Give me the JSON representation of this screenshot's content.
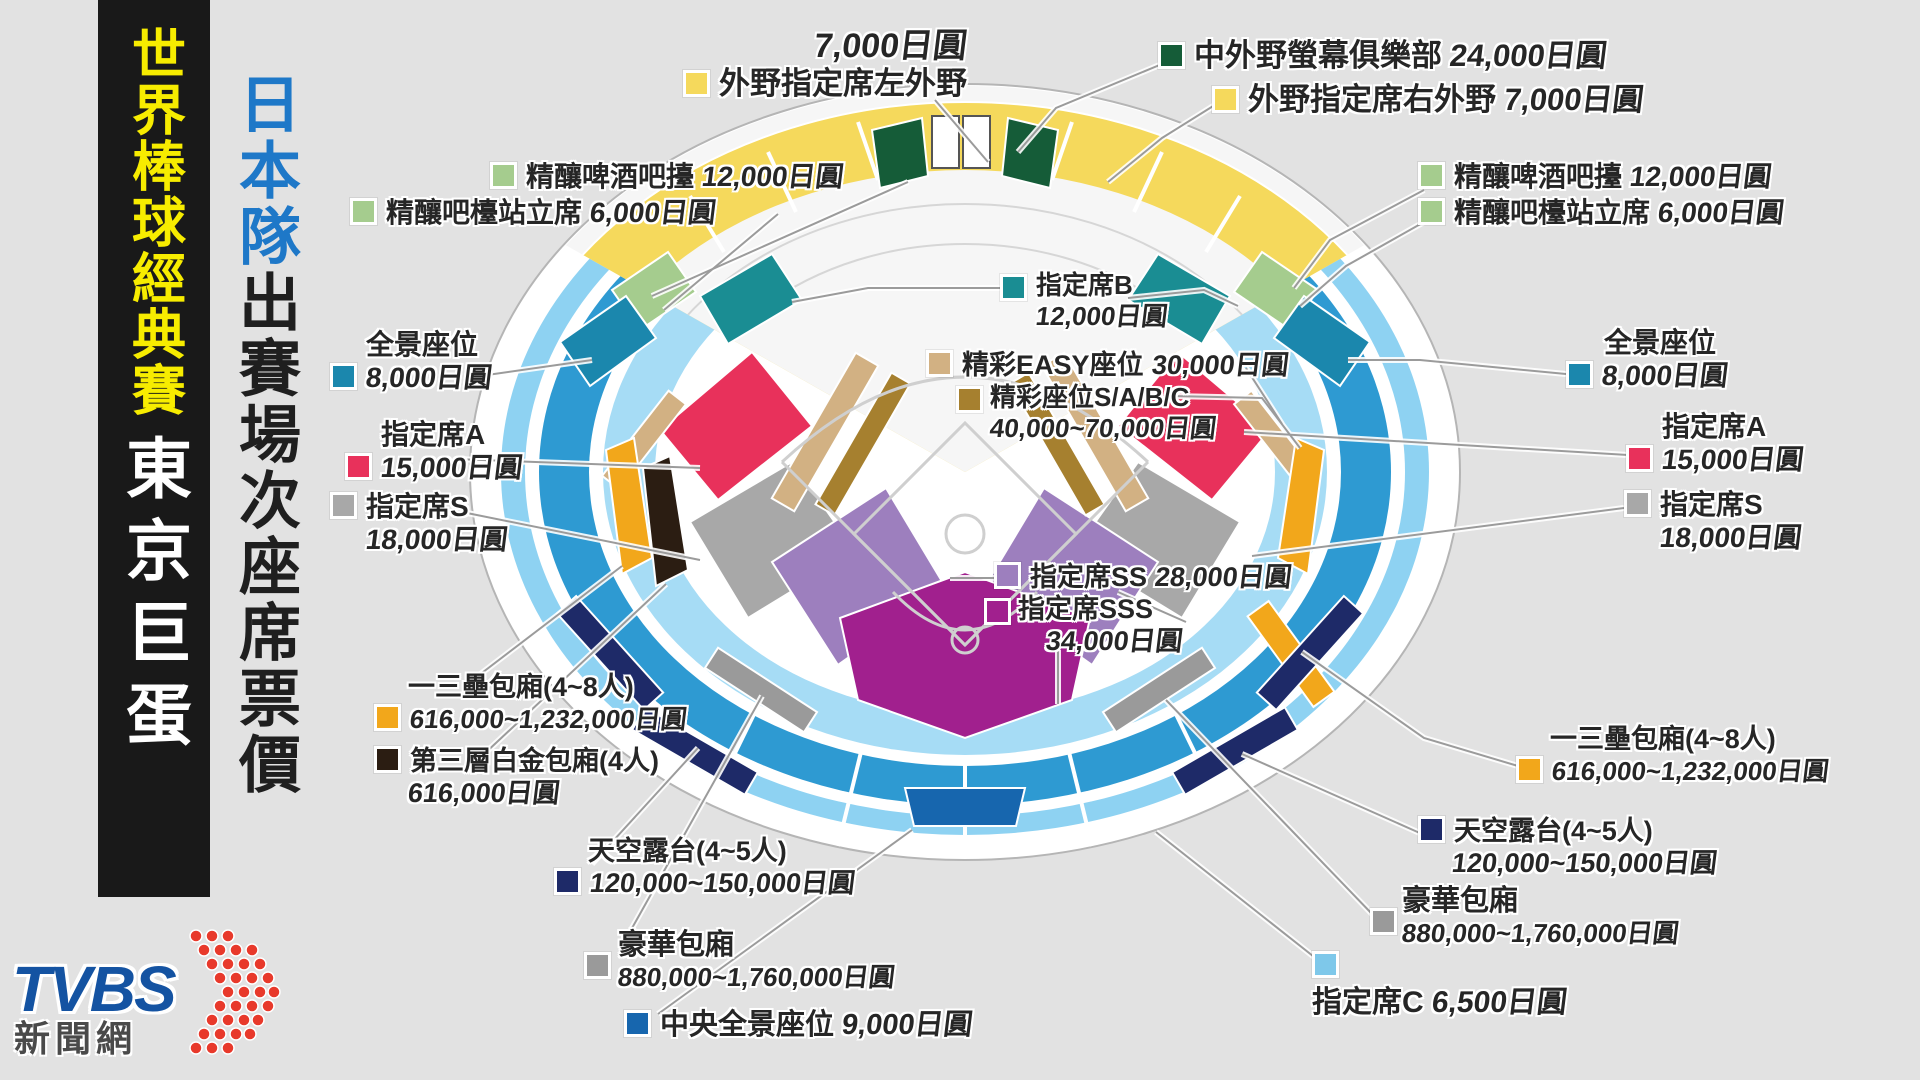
{
  "titles": {
    "main": "世界棒球經典賽",
    "venue": "東京巨蛋",
    "team": "日本隊",
    "subtitle": "出賽場次座席票價"
  },
  "logo": {
    "brand": "TVBS",
    "site": "新聞網"
  },
  "labels": {
    "lf_outfield": {
      "price": "7,000日圓",
      "name": "外野指定席左外野"
    },
    "screen_club": {
      "name": "中外野螢幕俱樂部",
      "price": "24,000日圓"
    },
    "rf_outfield": {
      "name": "外野指定席右外野",
      "price": "7,000日圓"
    },
    "beer_bar_left": {
      "name": "精釀啤酒吧擡",
      "price": "12,000日圓"
    },
    "beer_stand_left": {
      "name": "精釀吧檯站立席",
      "price": "6,000日圓"
    },
    "beer_bar_right": {
      "name": "精釀啤酒吧擡",
      "price": "12,000日圓"
    },
    "beer_stand_right": {
      "name": "精釀吧檯站立席",
      "price": "6,000日圓"
    },
    "seat_b": {
      "name": "指定席B",
      "price": "12,000日圓"
    },
    "easy_seat": {
      "name": "精彩EASY座位",
      "price": "30,000日圓"
    },
    "sabc_seat": {
      "name": "精彩座位S/A/B/C",
      "price": "40,000~70,000日圓"
    },
    "seat_ss": {
      "name": "指定席SS",
      "price": "28,000日圓"
    },
    "seat_sss": {
      "name": "指定席SSS",
      "price": "34,000日圓"
    },
    "pano_left": {
      "name": "全景座位",
      "price": "8,000日圓"
    },
    "seat_a_left": {
      "name": "指定席A",
      "price": "15,000日圓"
    },
    "seat_s_left": {
      "name": "指定席S",
      "price": "18,000日圓"
    },
    "pano_right": {
      "name": "全景座位",
      "price": "8,000日圓"
    },
    "seat_a_right": {
      "name": "指定席A",
      "price": "15,000日圓"
    },
    "seat_s_right": {
      "name": "指定席S",
      "price": "18,000日圓"
    },
    "box13_left": {
      "name": "一三壘包廂(4~8人)",
      "price": "616,000~1,232,000日圓"
    },
    "platinum_box": {
      "name": "第三層白金包廂(4人)",
      "price": "616,000日圓"
    },
    "sky_left": {
      "name": "天空露台(4~5人)",
      "price": "120,000~150,000日圓"
    },
    "lux_left": {
      "name": "豪華包廂",
      "price": "880,000~1,760,000日圓"
    },
    "central_pano": {
      "name": "中央全景座位",
      "price": "9,000日圓"
    },
    "box13_right": {
      "name": "一三壘包廂(4~8人)",
      "price": "616,000~1,232,000日圓"
    },
    "sky_right": {
      "name": "天空露台(4~5人)",
      "price": "120,000~150,000日圓"
    },
    "lux_right": {
      "name": "豪華包廂",
      "price": "880,000~1,760,000日圓"
    },
    "seat_c": {
      "name": "指定席C",
      "price": "6,500日圓"
    }
  },
  "colors": {
    "background": "#e2e2e2",
    "title_bar": "#191919",
    "title_yellow": "#f7ec00",
    "team_blue": "#1e78c8",
    "outfield_yellow": "#f5d95c",
    "screen_club_green": "#155c38",
    "beer_green": "#a5cc8e",
    "seat_b_teal": "#1a8d93",
    "pano_blue": "#1b87ad",
    "seat_a_pink": "#e8315b",
    "seat_s_gray": "#a8a8a8",
    "easy_tan": "#d2b183",
    "sabc_brown": "#a6802f",
    "seat_ss_purple": "#9d7fbe",
    "seat_sss_magenta": "#a1208e",
    "box13_orange": "#f2a71b",
    "platinum_black": "#2b1d12",
    "sky_navy": "#1e2a68",
    "lux_gray": "#9a9a9a",
    "central_pano_blue": "#1766ae",
    "seat_c_lightblue": "#7ec8ea",
    "tvbs_blue": "#1453a2",
    "tvbs_red": "#e8392b"
  }
}
